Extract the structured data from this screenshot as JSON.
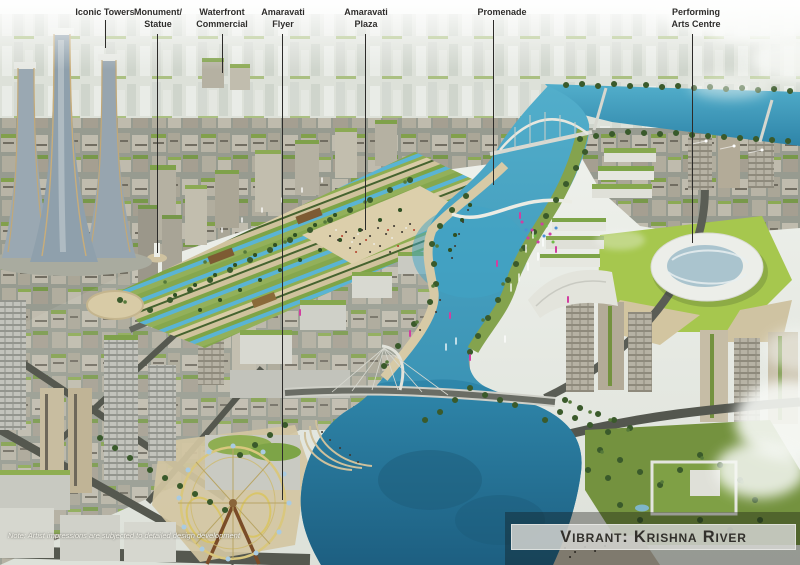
{
  "banner": {
    "title": "Vibrant: Krishna River"
  },
  "note": "Note: Artist impressions are subjected to detailed design development",
  "annotations": [
    {
      "id": "iconic-towers",
      "label": "Iconic Towers"
    },
    {
      "id": "monument-statue",
      "label": "Monument/ Statue"
    },
    {
      "id": "waterfront-commercial",
      "label": "Waterfront Commercial"
    },
    {
      "id": "amaravati-flyer",
      "label": "Amaravati Flyer"
    },
    {
      "id": "amaravati-plaza",
      "label": "Amaravati Plaza"
    },
    {
      "id": "promenade",
      "label": "Promenade"
    },
    {
      "id": "performing-arts-centre",
      "label": "Performing Arts Centre"
    }
  ],
  "colors": {
    "water": "#3b9cc0",
    "deep_water": "#22688c",
    "park_green": "#8fae52",
    "label_text": "#2e2d2b",
    "banner_bg": "#d5d6d2",
    "banner_text": "#32302c"
  }
}
